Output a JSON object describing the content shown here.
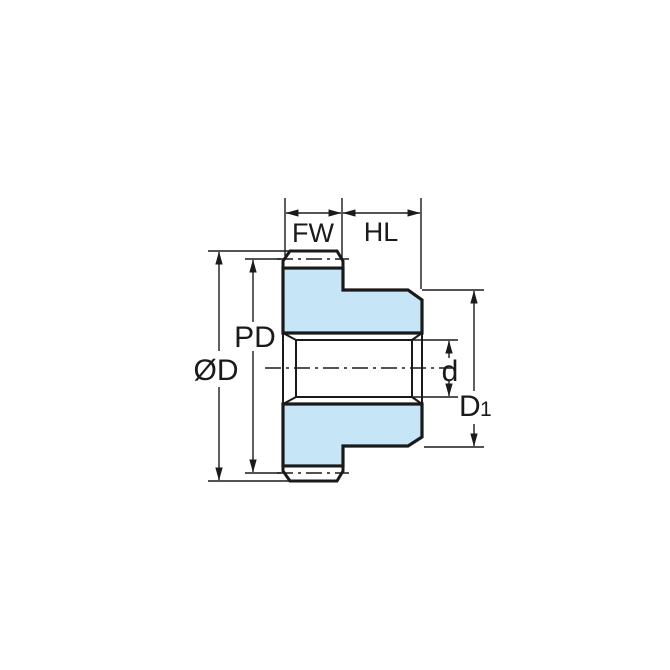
{
  "figure": {
    "labels": {
      "fw": "FW",
      "hl": "HL",
      "pd": "PD",
      "od": "ØD",
      "d": "d",
      "d1_base": "D",
      "d1_sub": "1"
    },
    "colors": {
      "part_fill": "#C6E6F8",
      "line": "#1A1A1A",
      "background": "#FFFFFF"
    }
  }
}
